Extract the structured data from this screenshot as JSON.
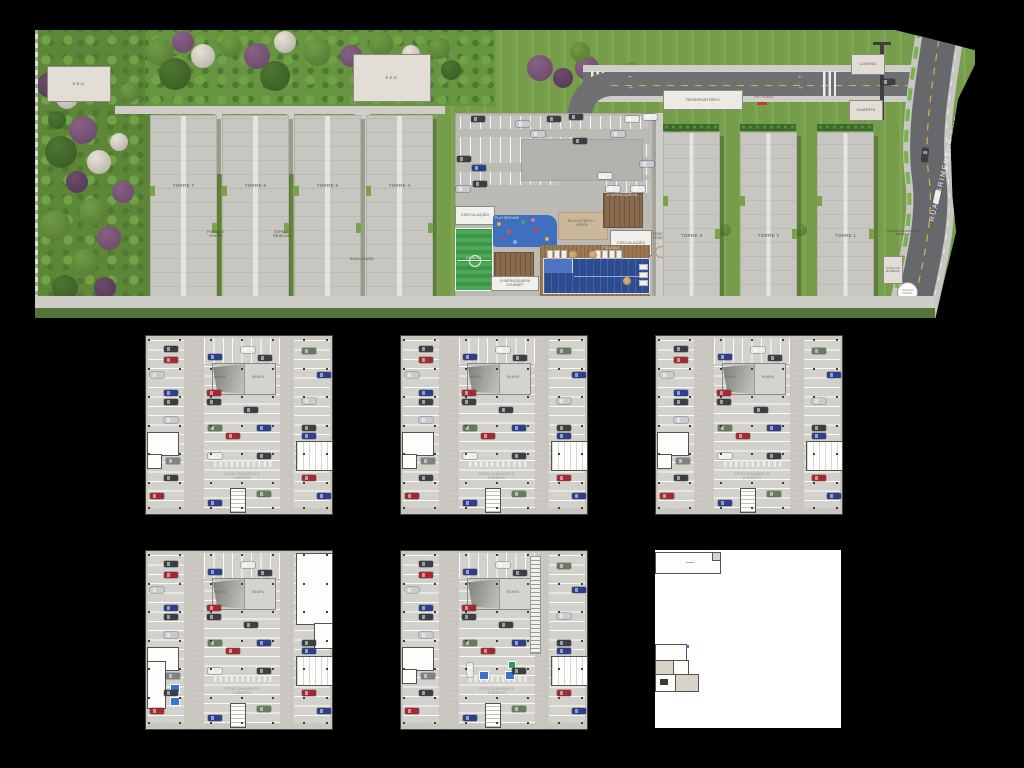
{
  "page": {
    "background": "#000000"
  },
  "colors": {
    "lawn": "#7aa24c",
    "forest": "#5d8638",
    "deck": "#bcbab5",
    "road": "#6e7072",
    "street": "#66686b",
    "pool": "#2c4b90",
    "court": "#3f9e4c",
    "playground": "#3e6fc1",
    "wood": "#9a7852"
  },
  "site_plan": {
    "labels": {
      "eed": "E.E.D.",
      "eee": "E.E.E.",
      "reservatorio": "RESERVATÓRIO",
      "pet_place": "PET PLACE",
      "lixeira": "LIXEIRA",
      "guarita": "GUARITA",
      "street": "RUA AGRIMENSOR SUGAYA",
      "pomar": "POMAR E HORTA",
      "espaco_brincar": "ESPAÇO BRINCAR",
      "boulevard": "BOULEVARD",
      "circulacao": "CIRCULAÇÃO",
      "quadra": "QUADRA",
      "playground": "PLAYGROUND",
      "churrasqueira_gourmet": "CHURRASQUEIRA GOURMET",
      "churrasqueira": "CHURRASQUEIRA",
      "bicicletario_horta": "BICICLETÁRIO + HORTA",
      "piscinas": "PISCINAS",
      "praca_fogueira": "PRAÇA DA FOGUEIRA",
      "transformador": "TRANSFORMADOR DE ENERGIA",
      "casa_bombas": "CASA DE BOMBAS",
      "castelo_dagua": "CASTELO D'ÁGUA"
    },
    "towers": [
      "TORRE 7",
      "TORRE 6",
      "TORRE 5",
      "TORRE 4",
      "TORRE 3",
      "TORRE 2",
      "TORRE 1"
    ]
  },
  "floor_plans": {
    "count": 6,
    "labels": {
      "rampa": "RAMPA",
      "estacionamento": "ESTACIONAMENTO COBERTO"
    }
  }
}
